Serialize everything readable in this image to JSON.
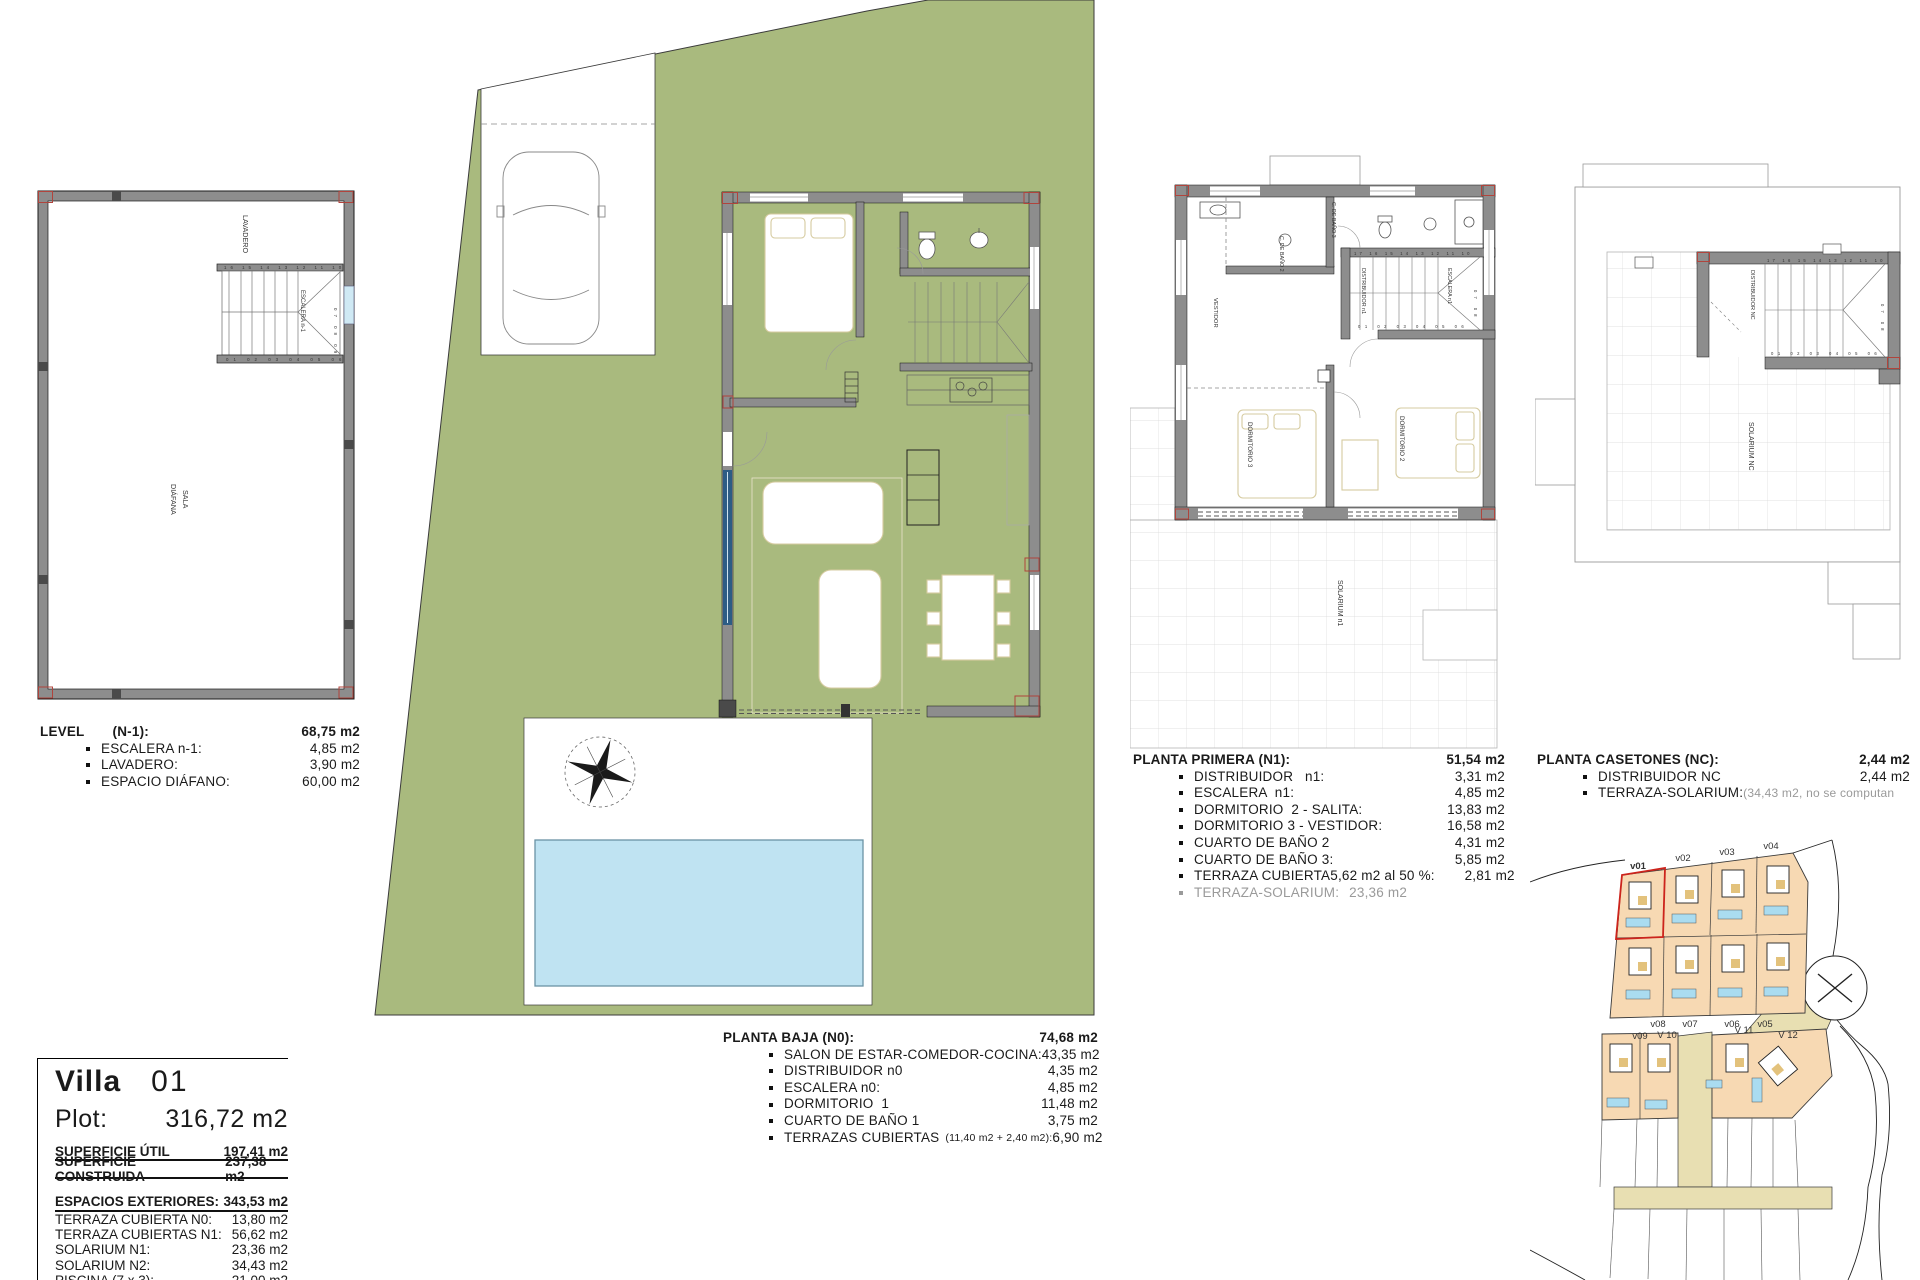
{
  "colors": {
    "plot_green": "#a9ba7e",
    "pool_blue": "#bfe3f2",
    "wall_gray": "#8d8d8d",
    "accent_red": "#b0443c",
    "map_plot_peach": "#f7d9b3",
    "map_road_beige": "#e8dfb2",
    "map_highlight_red": "#cc241c",
    "furniture_tan": "#d6cba0",
    "muted_text": "#9a9a9a"
  },
  "level_block": {
    "title": "LEVEL",
    "code": "(N-1):",
    "total": "68,75 m2",
    "items": [
      {
        "label": "ESCALERA n-1:",
        "value": "4,85 m2"
      },
      {
        "label": "LAVADERO:",
        "value": "3,90 m2"
      },
      {
        "label": "ESPACIO DIÁFANO:",
        "value": "60,00 m2"
      }
    ]
  },
  "planta_baja_block": {
    "title": "PLANTA BAJA (N0):",
    "total": "74,68 m2",
    "items": [
      {
        "label": "SALON DE ESTAR-COMEDOR-COCINA:",
        "value": "43,35 m2"
      },
      {
        "label": "DISTRIBUIDOR n0",
        "value": "4,35 m2"
      },
      {
        "label": "ESCALERA n0:",
        "value": "4,85 m2"
      },
      {
        "label": "DORMITORIO  1",
        "value": "11,48 m2"
      },
      {
        "label": "CUARTO DE BAÑO 1",
        "value": "3,75 m2"
      },
      {
        "label": "TERRAZAS CUBIERTAS",
        "note": "(11,40 m2 + 2,40 m2):",
        "value": "6,90 m2"
      }
    ]
  },
  "planta_primera_block": {
    "title": "PLANTA PRIMERA (N1):",
    "total": "51,54 m2",
    "items": [
      {
        "label": "DISTRIBUIDOR   n1:",
        "value": "3,31 m2"
      },
      {
        "label": "ESCALERA  n1:",
        "value": "4,85 m2"
      },
      {
        "label": "DORMITORIO  2 - SALITA:",
        "value": "13,83 m2"
      },
      {
        "label": "DORMITORIO 3 - VESTIDOR:",
        "value": "16,58 m2"
      },
      {
        "label": "CUARTO DE BAÑO 2",
        "value": "4,31 m2"
      },
      {
        "label": "CUARTO DE BAÑO 3:",
        "value": "5,85 m2"
      },
      {
        "label": "TERRAZA CUBIERTA",
        "note": "5,62 m2 al 50 %:",
        "value": "2,81 m2"
      }
    ],
    "muted_item": {
      "label": "TERRAZA-SOLARIUM:",
      "value": "23,36 m2"
    }
  },
  "planta_casetones_block": {
    "title": "PLANTA CASETONES (NC):",
    "total": "2,44 m2",
    "items": [
      {
        "label": "DISTRIBUIDOR NC",
        "value": "2,44 m2"
      },
      {
        "label": "TERRAZA-SOLARIUM:",
        "value_note": "(34,43 m2, no se computan"
      }
    ]
  },
  "villa_info": {
    "name": "Villa",
    "number": "01",
    "plot_label": "Plot:",
    "plot_value": "316,72 m2",
    "summary": [
      {
        "label": "SUPERFICIE ÚTIL",
        "value": "197,41 m2"
      },
      {
        "label": "SUPERFICIE CONSTRUIDA",
        "value": "237,38 m2"
      }
    ],
    "exterior_title": {
      "label": "ESPACIOS EXTERIORES:",
      "value": "343,53 m2"
    },
    "exterior_items": [
      {
        "label": "TERRAZA CUBIERTA N0:",
        "value": "13,80 m2"
      },
      {
        "label": "TERRAZA CUBIERTAS N1:",
        "value": "56,62 m2"
      },
      {
        "label": "SOLARIUM  N1:",
        "value": "23,36 m2"
      },
      {
        "label": "SOLARIUM  N2:",
        "value": "34,43 m2"
      },
      {
        "label": "PISCINA  (7 x 3):",
        "value": "21,00 m2"
      },
      {
        "label": "TERRAZAS Y JARDINES:",
        "value": "194,32 m2"
      }
    ]
  },
  "plan_basement": {
    "labels": {
      "lavadero": "LAVADERO",
      "escalera": "ESCALERA n-1",
      "sala_line1": "SALA",
      "sala_line2": "DIÁFANA"
    },
    "stair_numbers": {
      "top": "16 15 14 13 12 11 10",
      "bottom": "01 02 03 04 05 06",
      "side": "07 08 09"
    }
  },
  "plan_first": {
    "labels": {
      "bano3": "C. DE BAÑO 3",
      "bano2": "C. DE BAÑO 2",
      "vestidor": "VESTIDOR",
      "distribuidor": "DISTRIBUIDOR n1",
      "escalera": "ESCALERA n1",
      "dorm3": "DORMITORIO 3",
      "dorm2": "DORMITORIO 2",
      "solarium": "SOLARIUM n1"
    },
    "stair_numbers": {
      "top": "17 16 15 14 13 12 11 10",
      "bottom": "01 02 03 04 05 06",
      "side": "07 08"
    }
  },
  "plan_casetones": {
    "labels": {
      "distribuidor": "DISTRIBUIDOR NC",
      "solarium": "SOLARIUM NC"
    },
    "stair_numbers": {
      "top": "17 16 15 14 13 12 11 10",
      "bottom": "01 02 03 04 05 06",
      "side": "07 08"
    }
  },
  "site_map": {
    "labels_top": [
      "v01",
      "v02",
      "v03",
      "v04"
    ],
    "labels_mid": [
      "v08",
      "v07",
      "v06",
      "v05"
    ],
    "labels_low": [
      "v09",
      "V 10",
      "V 11",
      "V 12"
    ]
  }
}
